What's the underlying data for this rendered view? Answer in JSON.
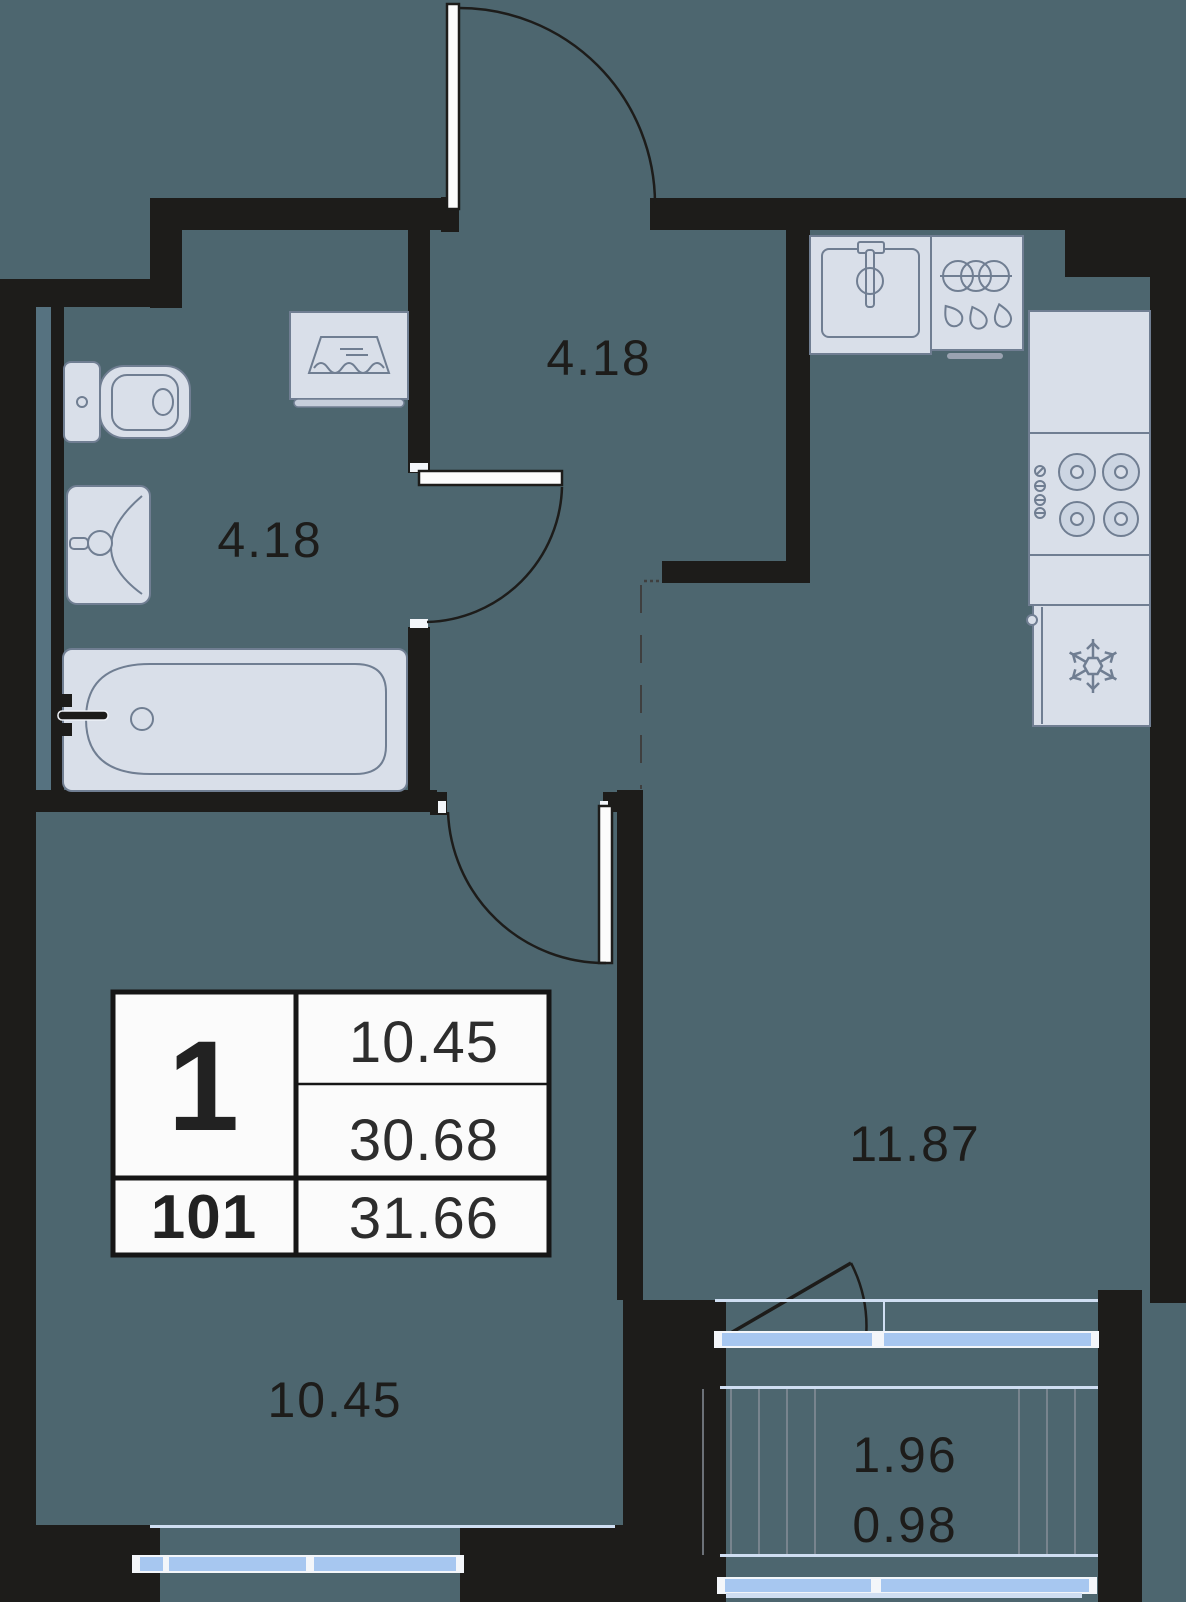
{
  "floorplan": {
    "info_card": {
      "rooms_count": "1",
      "unit_number": "101",
      "living_area": "10.45",
      "total_area": "30.68",
      "total_area_with_summer": "31.66"
    },
    "room_labels": {
      "bathroom": "4.18",
      "hallway": "4.18",
      "kitchen_living": "11.87",
      "room": "10.45",
      "balcony_full": "1.96",
      "balcony_reduced": "0.98"
    },
    "colors": {
      "background": "#4d666f",
      "wall": "#1d1c1a",
      "fixture_fill": "#d9dfe9",
      "fixture_stroke": "#707e92",
      "window_glass": "#a7c7f0",
      "card_background": "#fbfbfb",
      "balcony_hatch": "#878d98",
      "label_text": "#1d1c1a",
      "shaft_strip": "#567280"
    },
    "fixture_icons": {
      "bathroom": [
        "toilet-icon",
        "washing-machine-icon",
        "wash-basin-icon",
        "bathtub-icon"
      ],
      "kitchen": [
        "kitchen-sink-icon",
        "dish-rack-icon",
        "cooktop-icon",
        "fridge-snowflake-icon"
      ]
    }
  }
}
